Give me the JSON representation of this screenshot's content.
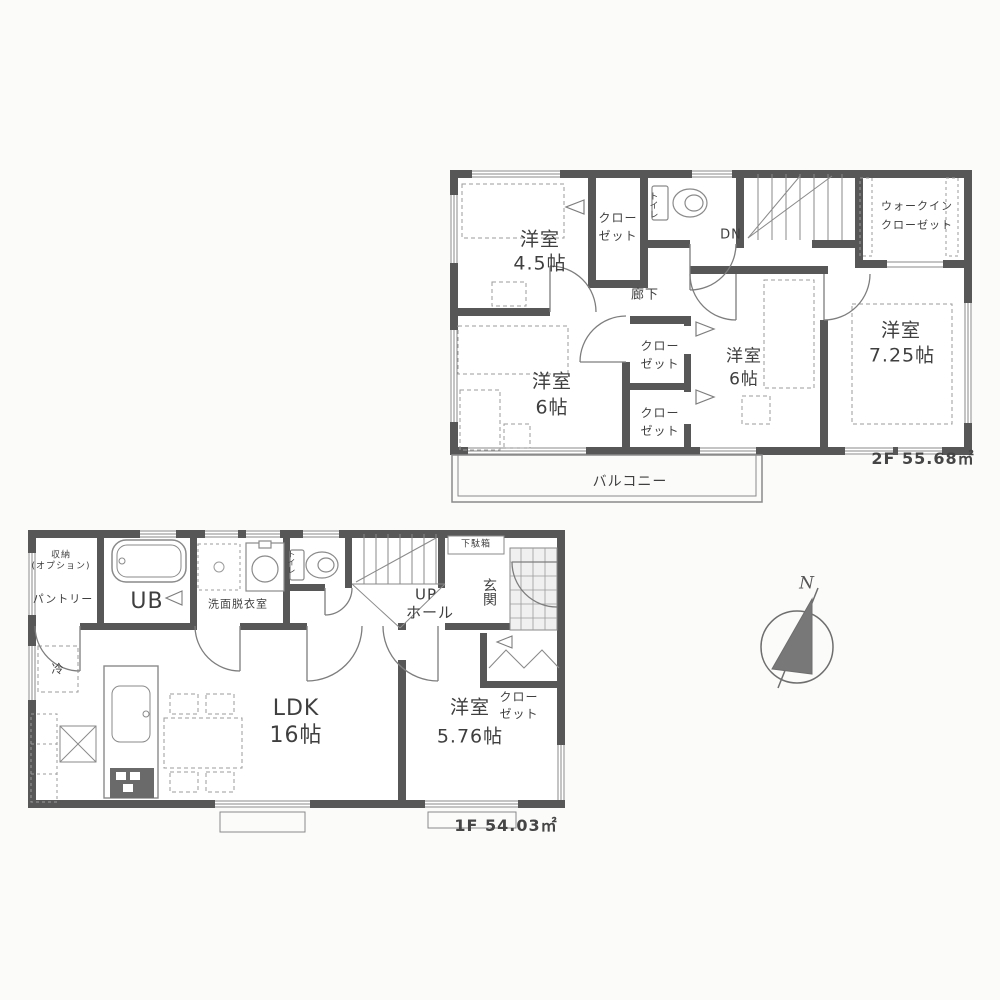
{
  "colors": {
    "wall": "#575757",
    "line": "#8a8a8a",
    "furniture_line": "#9b9b9b",
    "text": "#3f3f3f",
    "background": "#fbfbfa"
  },
  "floor2": {
    "area_label": "2F 55.68㎡",
    "rooms": {
      "room45": {
        "name": "洋室",
        "size": "4.5帖"
      },
      "room6_left": {
        "name": "洋室",
        "size": "6帖"
      },
      "room6_center": {
        "name": "洋室",
        "size": "6帖"
      },
      "room725": {
        "name": "洋室",
        "size": "7.25帖"
      }
    },
    "closet": {
      "line1": "クロー",
      "line2": "ゼット"
    },
    "wic": {
      "line1": "ウォークイン",
      "line2": "クローゼット"
    },
    "toilet": "トイレ",
    "stairs_dn": "DN",
    "hallway": "廊下",
    "balcony": "バルコニー"
  },
  "floor1": {
    "area_label": "1F 54.03㎡",
    "storage": {
      "line1": "収納",
      "line2": "(オプション)"
    },
    "pantry": "パントリー",
    "bath": "UB",
    "washroom": "洗面脱衣室",
    "toilet": "トイレ",
    "stairs_up": {
      "line1": "UP",
      "line2": "ホール"
    },
    "shoe_cabinet": "下駄箱",
    "entrance": "玄関",
    "closet": {
      "line1": "クロー",
      "line2": "ゼット"
    },
    "ldk": {
      "name": "LDK",
      "size": "16帖"
    },
    "room576": {
      "name": "洋室",
      "size": "5.76帖"
    },
    "fridge": "冷"
  },
  "compass": {
    "north": "N"
  }
}
